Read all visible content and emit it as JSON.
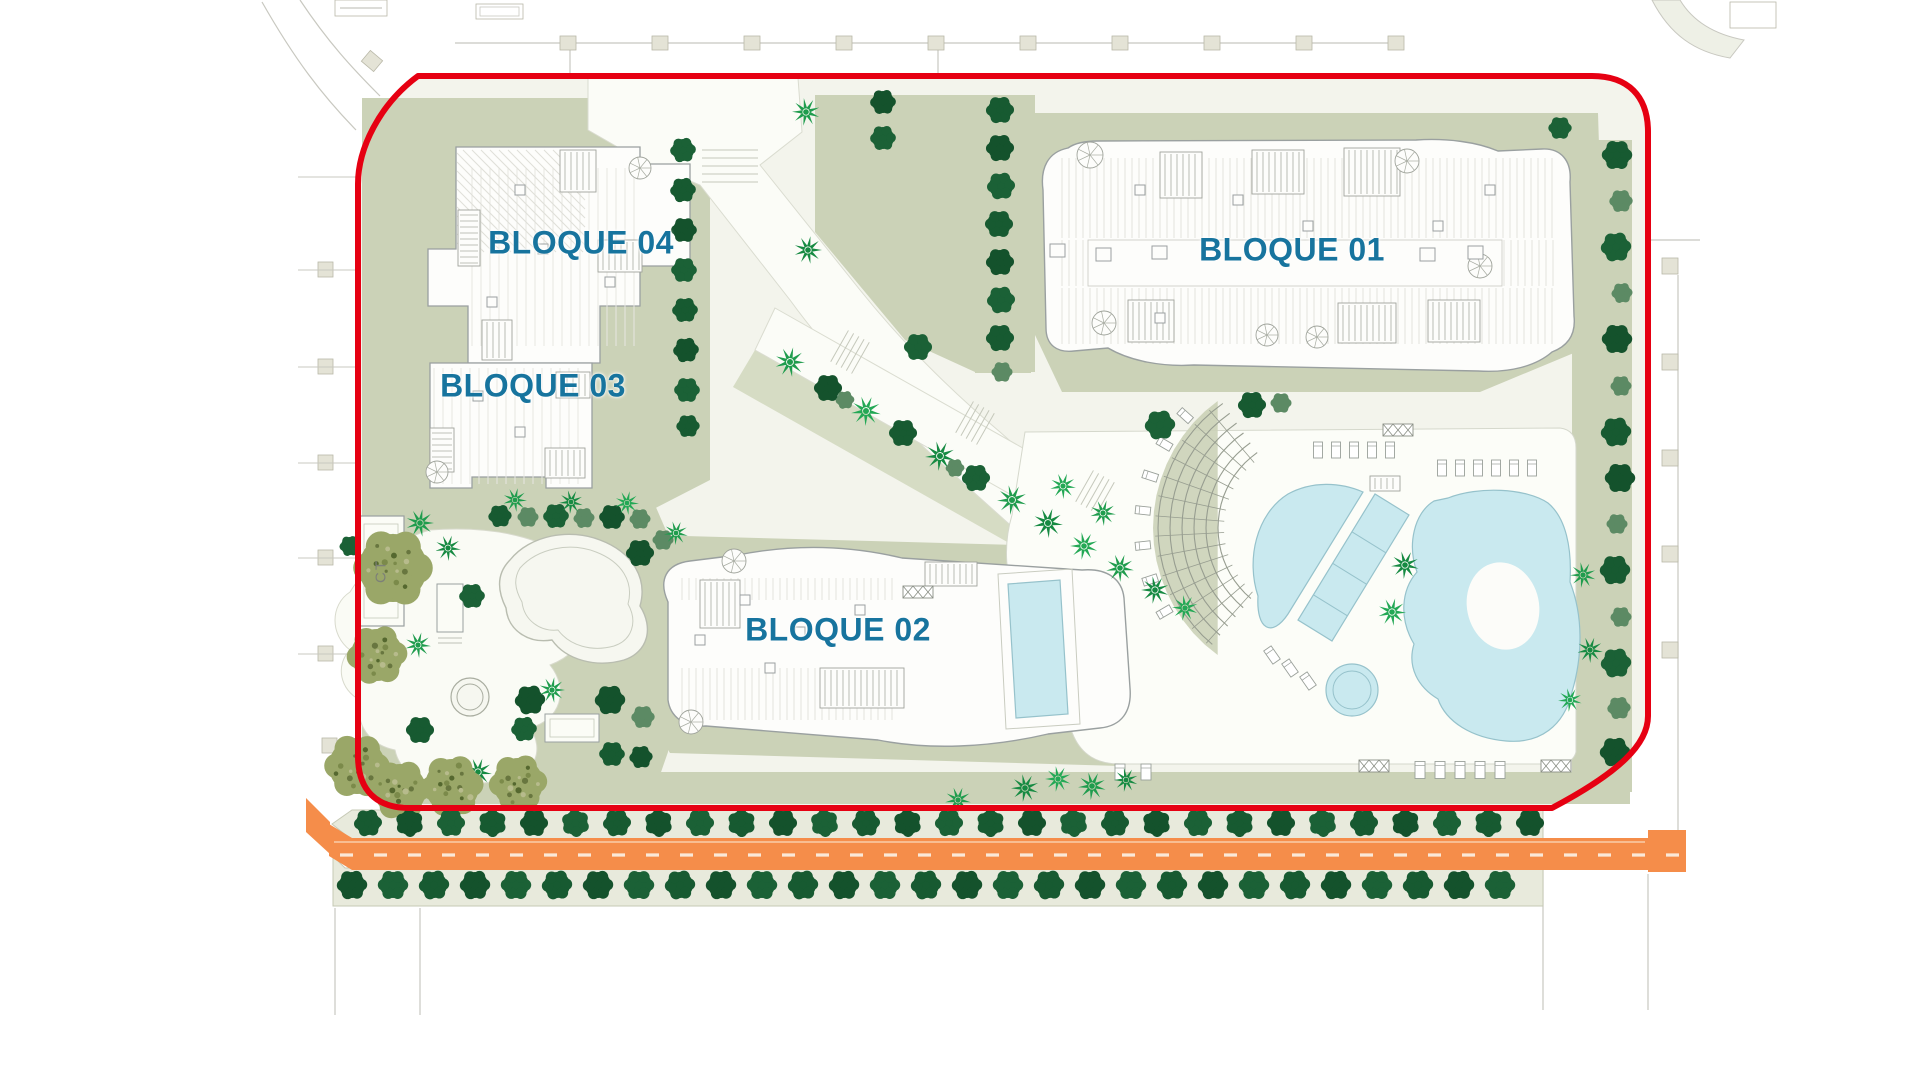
{
  "plan": {
    "type": "residential-site-plan",
    "blocks": [
      "BLOQUE 01",
      "BLOQUE 02",
      "BLOQUE 03",
      "BLOQUE 04"
    ]
  },
  "labels": {
    "bloque01": "BLOQUE 01",
    "bloque02": "BLOQUE 02",
    "bloque03": "BLOQUE 03",
    "bloque04": "BLOQUE 04",
    "ct": "CT"
  },
  "icons": {
    "round_tree": "tree-icon",
    "palm_tree": "palm-tree-icon",
    "textured_tree": "olive-tree-icon",
    "spiral_stair": "spiral-stair-icon",
    "sun_lounger": "sun-lounger-icon"
  },
  "colors": {
    "boundary": "#e60012",
    "label": "#17749e",
    "roadFill": "#f58d4a",
    "roadStripe": "#f8bd92",
    "roadDash": "#fbe8d8",
    "pool": "#c9e9ef",
    "poolEdge": "#96c2cb",
    "sage": "#cbd2b7",
    "sageLight": "#d6dcc4",
    "ground": "#f3f4ec",
    "strip": "#e8eadc",
    "treeDark": "#175a31",
    "treeMed": "#5c8a64",
    "palm": "#1f9c4d",
    "olive": "#9aa768",
    "line": "#9aa0a0",
    "faint": "#c8c8c0"
  }
}
